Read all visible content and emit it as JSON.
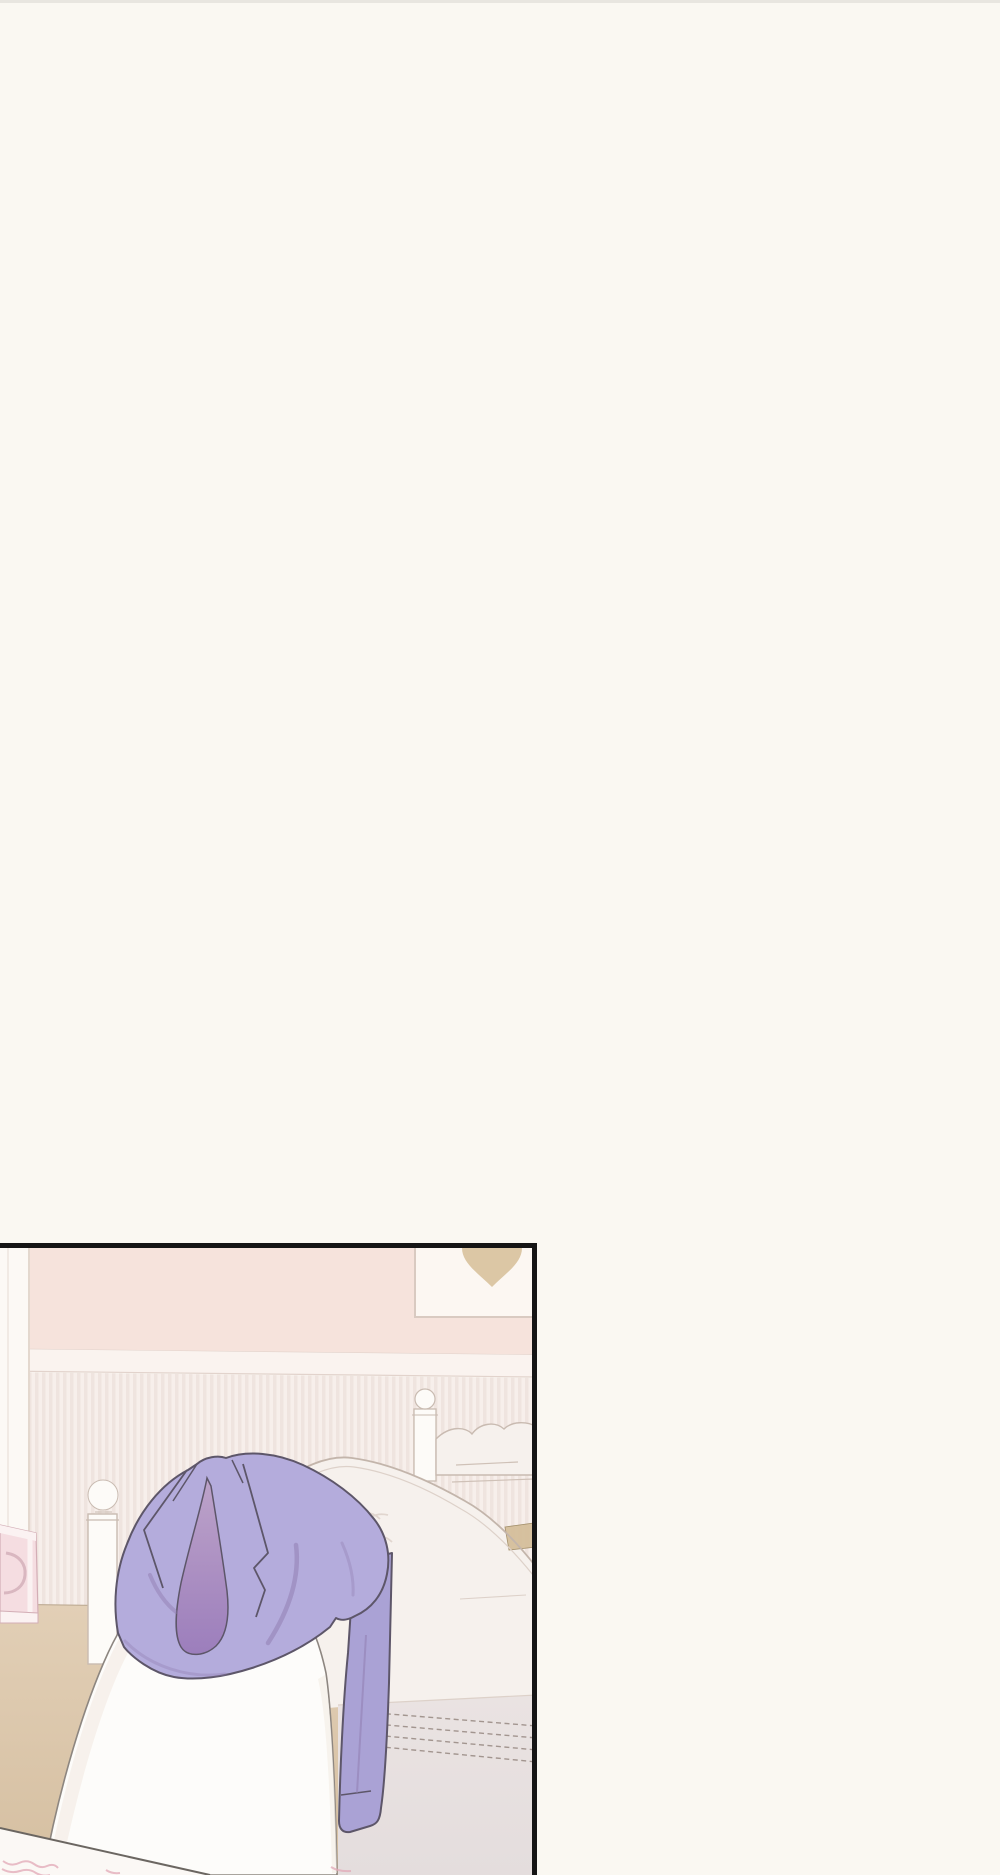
{
  "page": {
    "type": "webtoon-comic-page",
    "background_color": "#faf8f2",
    "width": 1000,
    "height": 1875,
    "text_content": "none"
  },
  "panel": {
    "x": 0,
    "y": 1243,
    "width": 537,
    "height": 632,
    "border_sides_visible": [
      "top",
      "right"
    ],
    "border_width": 5,
    "scene": "pastel bedroom with lavender jacket draped over white blanketed figure",
    "objects": [
      "pink wall",
      "wainscoting with vertical stripes",
      "picture frame with tan heart",
      "white wardrobe",
      "pink dresser with ring handle",
      "white nightstand with round lamp",
      "bed with ornate white headboard and ball-finial post",
      "tan pillow corner",
      "quilted mattress with stitch seams",
      "white blanket mound",
      "draped lavender jacket",
      "hanging jacket sleeve",
      "wooden floor",
      "sheet edge line",
      "pink blanket pattern squiggles"
    ]
  },
  "colors": {
    "page_bg": "#faf8f2",
    "border": "#151515",
    "wall_pink": "#f6e3dc",
    "rail": "#faf3ef",
    "rail_line": "#e2d3cc",
    "wainscot_light": "#f7efeb",
    "wainscot_dark": "#efe4df",
    "floor_light": "#e2cfb6",
    "floor_dark": "#d5bfa1",
    "floor_line": "#b9a68e",
    "wardrobe": "#fcf9f5",
    "wardrobe_line": "#ddcfc5",
    "dresser_pink": "#f5dde1",
    "dresser_trim": "#fbf2f2",
    "dresser_line": "#d3aeb6",
    "handle": "#d9b7c0",
    "stand_white": "#fdfbf8",
    "stand_line": "#c9bbb1",
    "headboard": "#f6f1ed",
    "headboard_line": "#c3b5ab",
    "headboard_inner_line": "#ddd1c9",
    "crest_detail": "#cfc1b7",
    "mattress": "#eae3e2",
    "mattress_low": "#e4dddd",
    "stitch": "#a2958f",
    "tan_pillow": "#d5bf9b",
    "tan_line": "#a08c66",
    "frame_bg": "#fcf7f2",
    "frame_line": "#d9cac1",
    "heart": "#dcc7a5",
    "blanket": "#fdfcfa",
    "blanket_shadow": "#f3ece5",
    "blanket_line": "#8d8680",
    "sheet_line": "#6b6661",
    "sheet_below": "#fbf8f5",
    "squiggle": "#e2a8b7",
    "jacket": "#b4acdc",
    "jacket_light": "#bab3e1",
    "sleeve": "#aaa2d5",
    "lining_top": "#bda3c9",
    "lining_bottom": "#9c7ebc",
    "jacket_outline": "#5d5669",
    "crease": "#8e7aae"
  }
}
